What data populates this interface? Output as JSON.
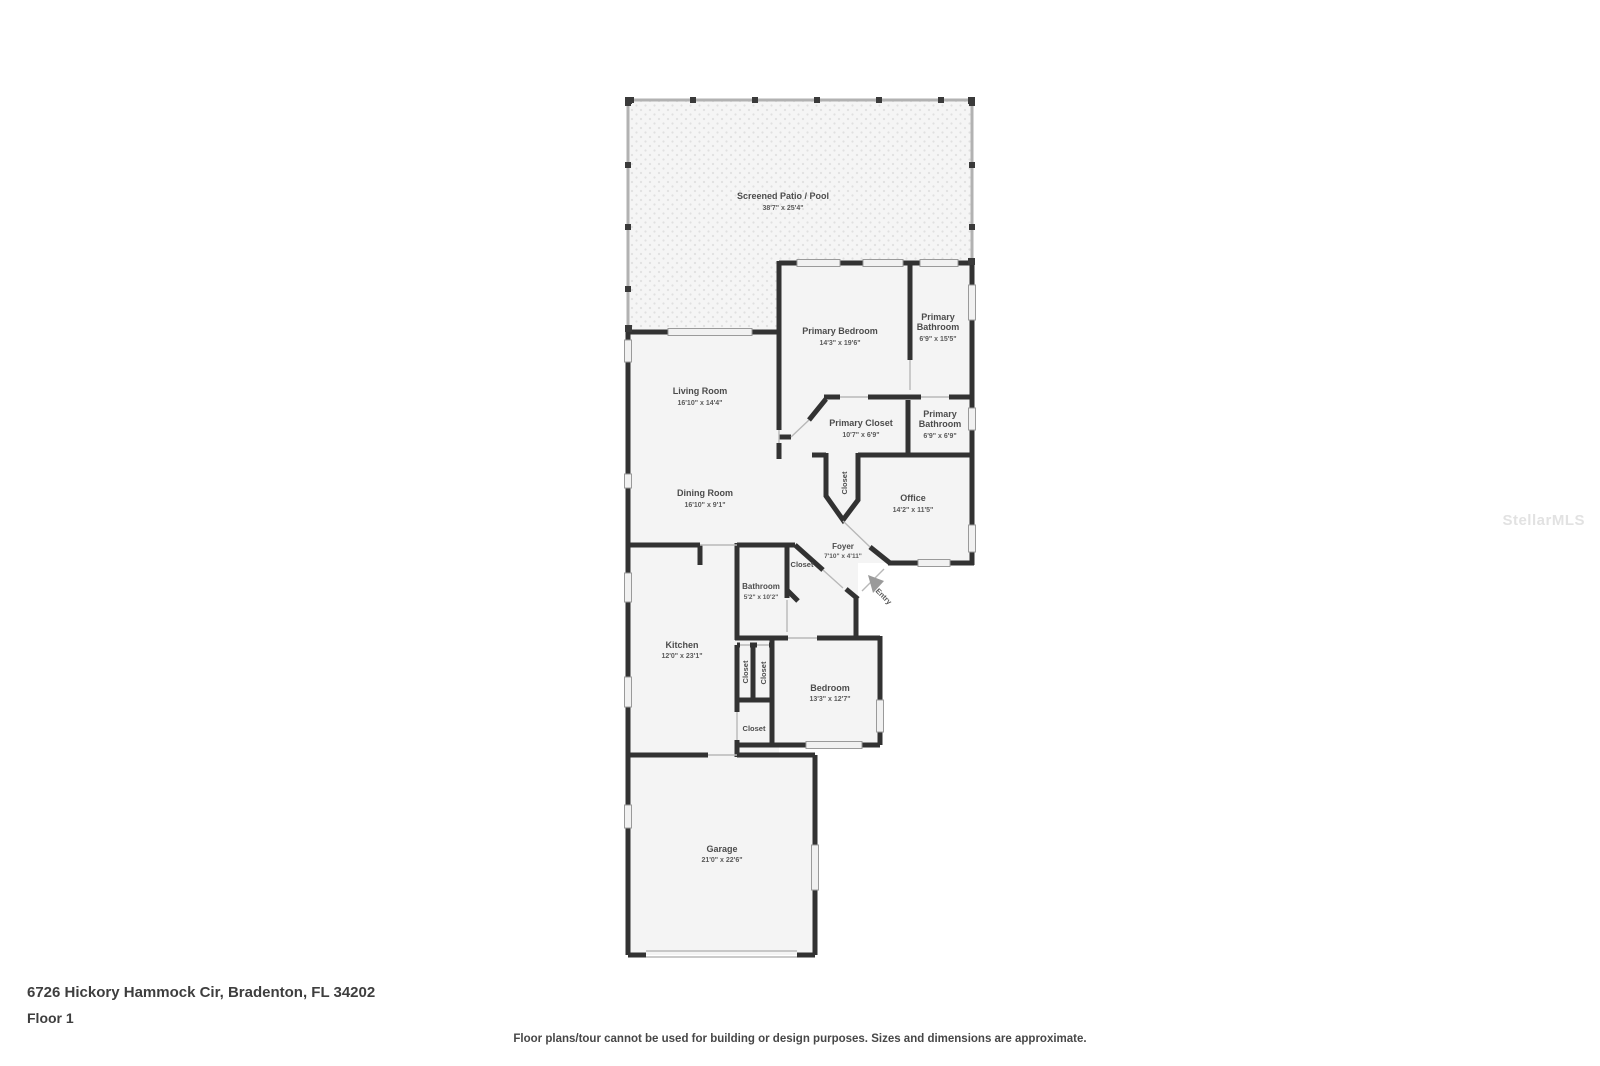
{
  "page": {
    "address": "6726 Hickory Hammock Cir, Bradenton, FL 34202",
    "floor_label": "Floor 1",
    "disclaimer": "Floor plans/tour cannot be used for building or design purposes. Sizes and dimensions are approximate.",
    "watermark": "StellarMLS"
  },
  "floor_plan": {
    "rooms": [
      {
        "name": "Screened Patio / Pool",
        "dims": "38'7\" x 25'4\""
      },
      {
        "name": "Living Room",
        "dims": "16'10\" x 14'4\""
      },
      {
        "name": "Primary Bedroom",
        "dims": "14'3\" x 19'6\""
      },
      {
        "name": "Primary",
        "name2": "Bathroom",
        "dims": "6'9\" x 15'5\""
      },
      {
        "name": "Primary Closet",
        "dims": "10'7\" x 6'9\""
      },
      {
        "name": "Primary",
        "name2": "Bathroom",
        "dims": "6'9\" x 6'9\""
      },
      {
        "name": "Office",
        "dims": "14'2\" x 11'5\""
      },
      {
        "name": "Dining Room",
        "dims": "16'10\" x 9'1\""
      },
      {
        "name": "Foyer",
        "dims": "7'10\" x 4'11\""
      },
      {
        "name": "Bathroom",
        "dims": "5'2\" x 10'2\""
      },
      {
        "name": "Kitchen",
        "dims": "12'0\" x 23'1\""
      },
      {
        "name": "Bedroom",
        "dims": "13'3\" x 12'7\""
      },
      {
        "name": "Garage",
        "dims": "21'0\" x 22'6\""
      }
    ],
    "closet_labels": [
      "Closet",
      "Closet",
      "Closet",
      "Closet",
      "Closet"
    ],
    "entry_label": "Entry"
  },
  "colors": {
    "wall": "#323232",
    "room_fill": "#f4f4f4",
    "patio_dot": "#e0e0e0",
    "label_text": "#4c4c4c",
    "opening_line": "#b8b8b8",
    "window_fill": "#f1f1f1",
    "screen_wall": "#b2b2b2",
    "entry_arrow": "#9a9a9a",
    "watermark": "#e2e2e2",
    "footer_text": "#3e3e3e"
  }
}
